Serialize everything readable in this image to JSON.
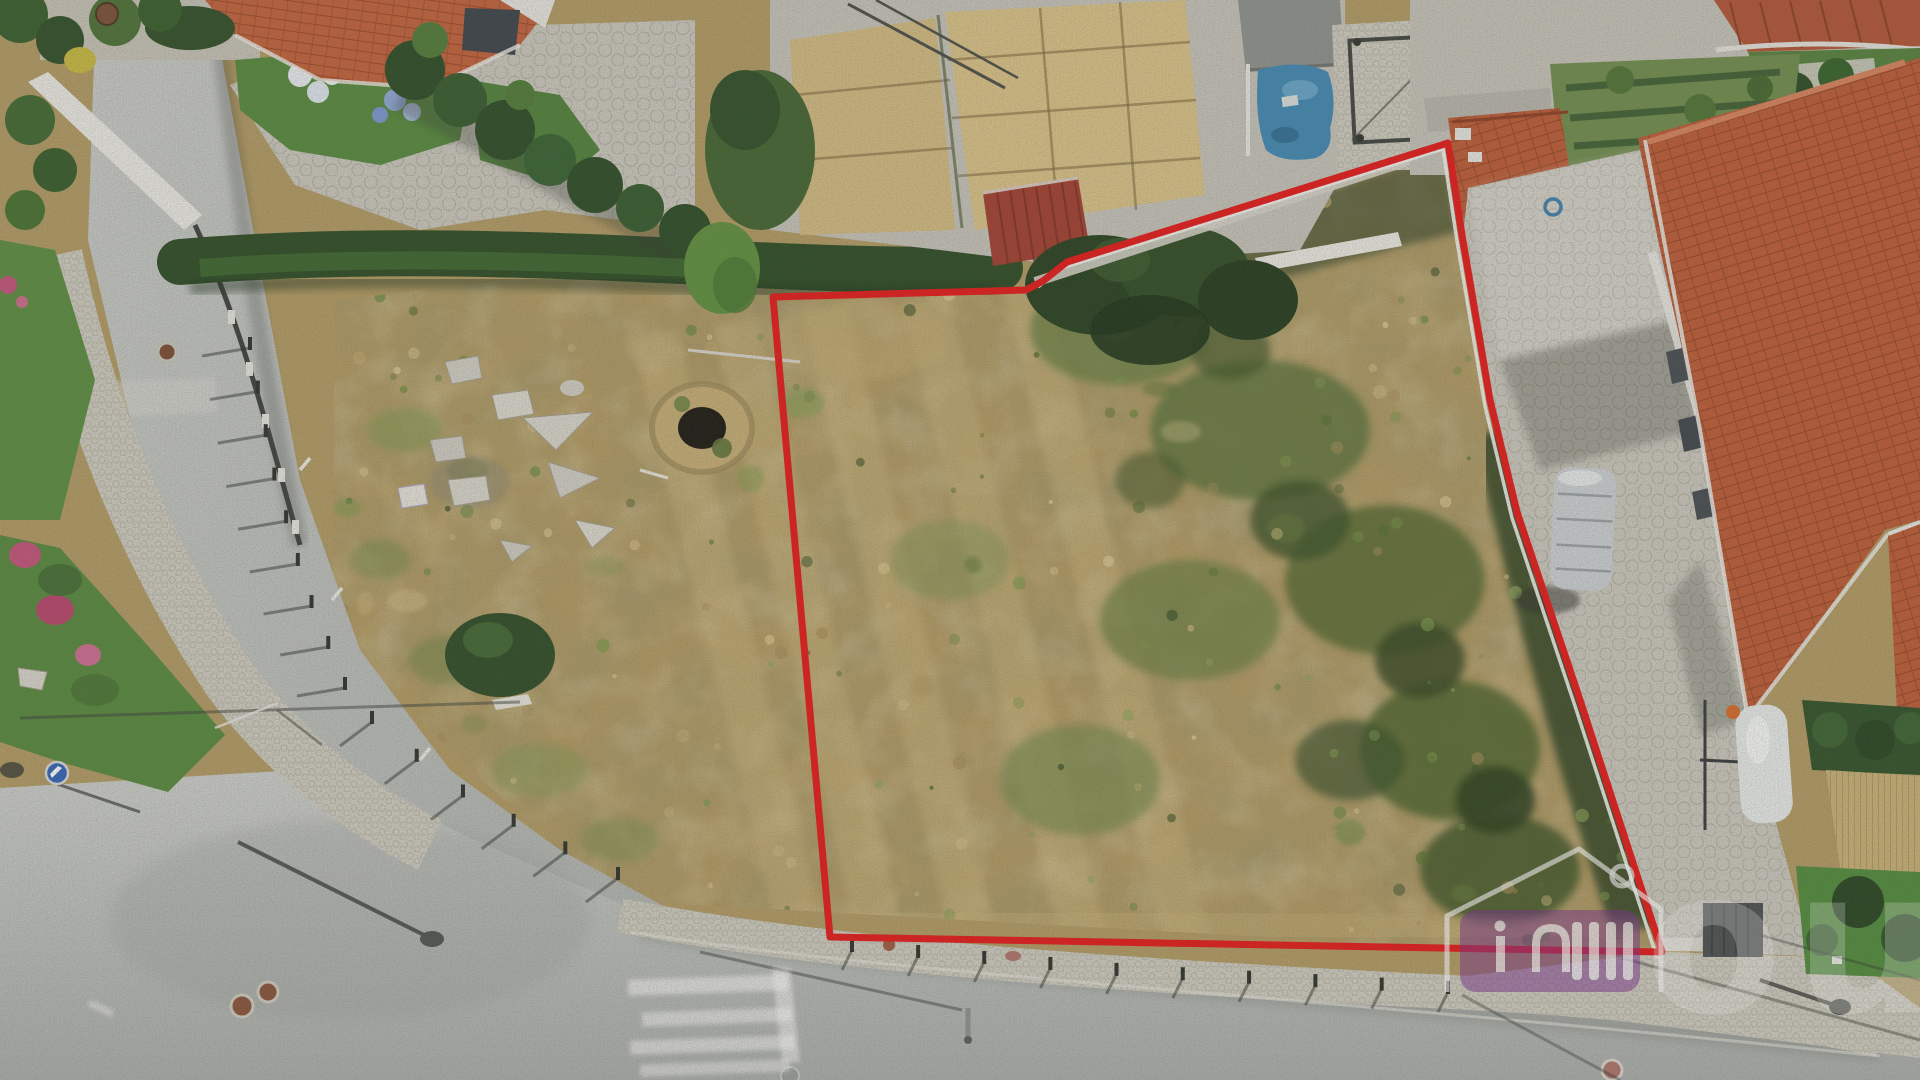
{
  "image": {
    "type": "aerial-drone-photograph",
    "subject": "Vacant corner land plot with dry grass outlined in red, between a curved street, a bottom street and houses with terracotta roofs"
  },
  "boundary": {
    "color": "#e61717",
    "inner_line_color": "#f5f4ef",
    "points_str": "773,297 1026,290 1043,281 1067,262 1448,143 1462,235 1490,400 1517,512 1580,700 1662,952 830,937",
    "inner_points_str": "1043,281 1067,262 1448,143 1462,235 1490,400 1517,512 1580,700 1662,952"
  },
  "watermark": {
    "name": "real-estate-agency-watermark",
    "letters": "out",
    "badge_color": "#7c2f8f",
    "outline_color": "#ffffff",
    "opacity": "0.85",
    "letters_opacity": "0.30"
  },
  "palette": {
    "dry_grass": "#b29a62",
    "dry_grass_light": "#d2bc82",
    "green_vegetation": "#5d7338",
    "dark_hedge": "#2b4a22",
    "terracotta_roof": "#bd5a34",
    "asphalt": "#c2c4c2",
    "sidewalk_cobble": "#cfccc0",
    "straw_pen": "#dac287",
    "blue_tarp": "#3f88b4",
    "lawn": "#4f8a3a"
  }
}
